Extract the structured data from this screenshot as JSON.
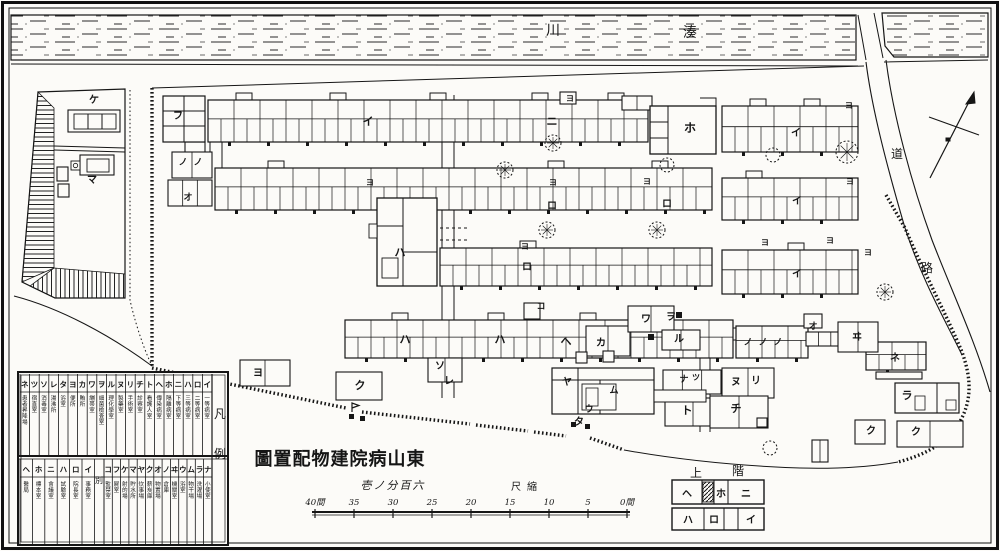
{
  "title": {
    "display": "圖置配物建院病山東"
  },
  "scale": {
    "caption": "壱ノ分百六",
    "unit_label": "尺縮",
    "ticks": [
      "40間",
      "35",
      "30",
      "25",
      "20",
      "15",
      "10",
      "5",
      "0間"
    ]
  },
  "river": {
    "kawa": "川",
    "minato": "湊"
  },
  "roads": {
    "michi": "道",
    "ro": "路"
  },
  "legend": {
    "corner_top": "凡",
    "corner_bottom": "例",
    "divider": "別",
    "row1": [
      {
        "kana": "ネ",
        "desc": "患者昇降場"
      },
      {
        "kana": "ツ",
        "desc": "宿直室"
      },
      {
        "kana": "ソ",
        "desc": "消毒室"
      },
      {
        "kana": "レ",
        "desc": "湯沸所"
      },
      {
        "kana": "タ",
        "desc": "浴室"
      },
      {
        "kana": "ヨ",
        "desc": "便所"
      },
      {
        "kana": "カ",
        "desc": "賄所"
      },
      {
        "kana": "ワ",
        "desc": "繃帯室"
      },
      {
        "kana": "ヲ",
        "desc": "細菌檢査室"
      },
      {
        "kana": "ル",
        "desc": "理化學室"
      },
      {
        "kana": "ヌ",
        "desc": "製藥室"
      },
      {
        "kana": "リ",
        "desc": "手術室"
      },
      {
        "kana": "チ",
        "desc": "診察室"
      },
      {
        "kana": "ト",
        "desc": "看護人室"
      },
      {
        "kana": "ヘ",
        "desc": "傳染病室"
      },
      {
        "kana": "ホ",
        "desc": "隔離病室"
      },
      {
        "kana": "ニ",
        "desc": "下等病室"
      },
      {
        "kana": "ハ",
        "desc": "三等病室"
      },
      {
        "kana": "ロ",
        "desc": "二等病室"
      },
      {
        "kana": "イ",
        "desc": "一等病室"
      }
    ],
    "row2_annex": [
      {
        "kana": "ヘ",
        "desc": "醫局"
      },
      {
        "kana": "ホ",
        "desc": "標本室"
      },
      {
        "kana": "ニ",
        "desc": "會議室"
      },
      {
        "kana": "ハ",
        "desc": "試驗室"
      },
      {
        "kana": "ロ",
        "desc": "院長室"
      },
      {
        "kana": "イ",
        "desc": "事務室"
      }
    ],
    "row2_main": [
      {
        "kana": "コ",
        "desc": "監禁室"
      },
      {
        "kana": "フ",
        "desc": "屍室"
      },
      {
        "kana": "ケ",
        "desc": "射的場"
      },
      {
        "kana": "マ",
        "desc": "貯水所"
      },
      {
        "kana": "ヤ",
        "desc": "炊事場"
      },
      {
        "kana": "ク",
        "desc": "薪炭庫"
      },
      {
        "kana": "オ",
        "desc": "物置場"
      },
      {
        "kana": "ノ",
        "desc": "倉庫"
      },
      {
        "kana": "ヰ",
        "desc": "機關室"
      },
      {
        "kana": "ウ",
        "desc": "浴室"
      },
      {
        "kana": "ム",
        "desc": "物干場"
      },
      {
        "kana": "ラ",
        "desc": "洗濯場"
      },
      {
        "kana": "ナ",
        "desc": "小使室"
      }
    ]
  },
  "inset": {
    "title_left": "上",
    "title_right": "階",
    "top_cells": [
      "ヘ",
      "ホ",
      "ニ"
    ],
    "bottom_cells": [
      "ハ",
      "ロ",
      "イ"
    ]
  },
  "map_labels": [
    {
      "t": "ケ",
      "x": 94,
      "y": 103,
      "s": 10
    },
    {
      "t": "マ",
      "x": 92,
      "y": 183,
      "s": 10
    },
    {
      "t": "フ",
      "x": 178,
      "y": 119,
      "s": 10
    },
    {
      "t": "ノ",
      "x": 183,
      "y": 165,
      "s": 9
    },
    {
      "t": "ノ",
      "x": 198,
      "y": 165,
      "s": 9
    },
    {
      "t": "オ",
      "x": 188,
      "y": 200,
      "s": 9
    },
    {
      "t": "イ",
      "x": 368,
      "y": 125,
      "s": 11
    },
    {
      "t": "ニ",
      "x": 552,
      "y": 125,
      "s": 11
    },
    {
      "t": "ヨ",
      "x": 570,
      "y": 101,
      "s": 8
    },
    {
      "t": "ホ",
      "x": 690,
      "y": 132,
      "s": 12
    },
    {
      "t": "イ",
      "x": 796,
      "y": 136,
      "s": 10
    },
    {
      "t": "ヨ",
      "x": 849,
      "y": 108,
      "s": 8
    },
    {
      "t": "ロ",
      "x": 552,
      "y": 209,
      "s": 10
    },
    {
      "t": "ロ",
      "x": 667,
      "y": 207,
      "s": 10
    },
    {
      "t": "ヨ",
      "x": 370,
      "y": 185,
      "s": 8
    },
    {
      "t": "ヨ",
      "x": 553,
      "y": 185,
      "s": 8
    },
    {
      "t": "ヨ",
      "x": 647,
      "y": 184,
      "s": 8
    },
    {
      "t": "イ",
      "x": 797,
      "y": 204,
      "s": 10
    },
    {
      "t": "ヨ",
      "x": 765,
      "y": 245,
      "s": 8
    },
    {
      "t": "ヨ",
      "x": 830,
      "y": 243,
      "s": 8
    },
    {
      "t": "ヨ",
      "x": 850,
      "y": 184,
      "s": 8
    },
    {
      "t": "ハ",
      "x": 400,
      "y": 256,
      "s": 11
    },
    {
      "t": "ロ",
      "x": 527,
      "y": 270,
      "s": 10
    },
    {
      "t": "ヨ",
      "x": 525,
      "y": 249,
      "s": 8
    },
    {
      "t": "イ",
      "x": 797,
      "y": 277,
      "s": 10
    },
    {
      "t": "ヨ",
      "x": 868,
      "y": 255,
      "s": 8
    },
    {
      "t": "コ",
      "x": 541,
      "y": 309,
      "s": 9
    },
    {
      "t": "ハ",
      "x": 405,
      "y": 343,
      "s": 11
    },
    {
      "t": "ハ",
      "x": 500,
      "y": 343,
      "s": 11
    },
    {
      "t": "ヘ",
      "x": 566,
      "y": 345,
      "s": 11
    },
    {
      "t": "カ",
      "x": 601,
      "y": 346,
      "s": 10
    },
    {
      "t": "ワ",
      "x": 646,
      "y": 322,
      "s": 10
    },
    {
      "t": "ヲ",
      "x": 671,
      "y": 320,
      "s": 10
    },
    {
      "t": "ル",
      "x": 679,
      "y": 342,
      "s": 10
    },
    {
      "t": "ノ",
      "x": 748,
      "y": 345,
      "s": 9
    },
    {
      "t": "ノ",
      "x": 763,
      "y": 345,
      "s": 9
    },
    {
      "t": "ノ",
      "x": 778,
      "y": 345,
      "s": 9
    },
    {
      "t": "オ",
      "x": 813,
      "y": 329,
      "s": 9
    },
    {
      "t": "ヰ",
      "x": 857,
      "y": 340,
      "s": 10
    },
    {
      "t": "ネ",
      "x": 895,
      "y": 361,
      "s": 10
    },
    {
      "t": "ソ",
      "x": 440,
      "y": 369,
      "s": 10
    },
    {
      "t": "レ",
      "x": 449,
      "y": 384,
      "s": 10
    },
    {
      "t": "ク",
      "x": 360,
      "y": 389,
      "s": 11
    },
    {
      "t": "ヨ",
      "x": 258,
      "y": 376,
      "s": 10
    },
    {
      "t": "ヤ",
      "x": 567,
      "y": 385,
      "s": 10
    },
    {
      "t": "ム",
      "x": 614,
      "y": 393,
      "s": 9
    },
    {
      "t": "ウ",
      "x": 589,
      "y": 412,
      "s": 9
    },
    {
      "t": "タ",
      "x": 579,
      "y": 425,
      "s": 10
    },
    {
      "t": "ナ",
      "x": 684,
      "y": 382,
      "s": 9
    },
    {
      "t": "ツ",
      "x": 696,
      "y": 380,
      "s": 8
    },
    {
      "t": "ヌ",
      "x": 736,
      "y": 385,
      "s": 10
    },
    {
      "t": "リ",
      "x": 756,
      "y": 384,
      "s": 10
    },
    {
      "t": "ト",
      "x": 687,
      "y": 414,
      "s": 11
    },
    {
      "t": "チ",
      "x": 736,
      "y": 412,
      "s": 11
    },
    {
      "t": "ラ",
      "x": 907,
      "y": 399,
      "s": 11
    },
    {
      "t": "ク",
      "x": 871,
      "y": 434,
      "s": 10
    },
    {
      "t": "ク",
      "x": 916,
      "y": 435,
      "s": 10
    }
  ]
}
